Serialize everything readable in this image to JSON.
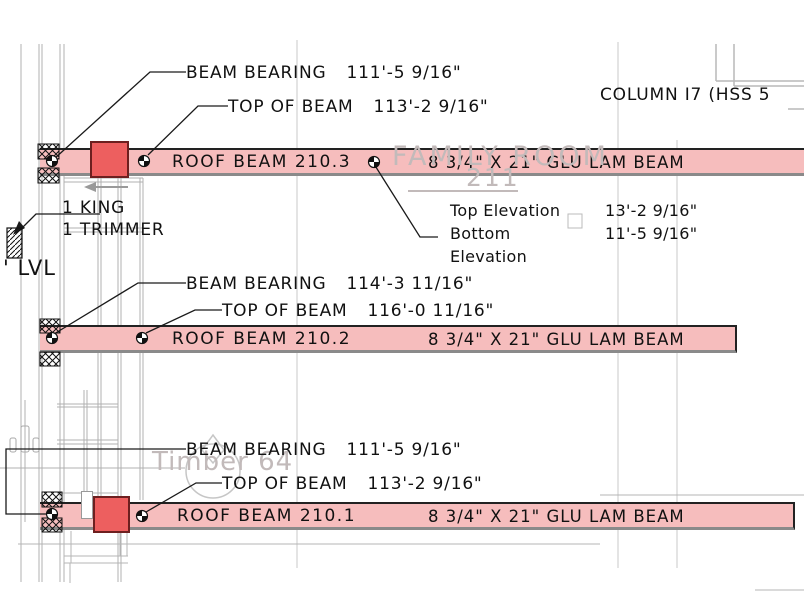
{
  "annotations": {
    "beam_bearing_1": {
      "label": "BEAM BEARING",
      "value": "111'-5 9/16\""
    },
    "top_of_beam_1": {
      "label": "TOP OF BEAM",
      "value": "113'-2 9/16\""
    },
    "beam_bearing_2": {
      "label": "BEAM BEARING",
      "value": "114'-3 11/16\""
    },
    "top_of_beam_2": {
      "label": "TOP OF BEAM",
      "value": "116'-0 11/16\""
    },
    "beam_bearing_3": {
      "label": "BEAM BEARING",
      "value": "111'-5 9/16\""
    },
    "top_of_beam_3": {
      "label": "TOP OF BEAM",
      "value": "113'-2 9/16\""
    },
    "column_label": "COLUMN I7 (HSS 5",
    "king": "1 KING",
    "trimmer": "1 TRIMMER",
    "lvl": "' LVL",
    "top_elev_label": "Top Elevation",
    "top_elev_value": "13'-2 9/16\"",
    "bottom_elev_label_1": "Bottom",
    "bottom_elev_label_2": "Elevation",
    "bottom_elev_value": "11'-5 9/16\""
  },
  "beams": [
    {
      "name": "ROOF BEAM 210.3",
      "size": "8 3/4\" X 21\" GLU LAM BEAM"
    },
    {
      "name": "ROOF BEAM 210.2",
      "size": "8 3/4\" X 21\" GLU LAM BEAM"
    },
    {
      "name": "ROOF BEAM 210.1",
      "size": "8 3/4\" X 21\" GLU LAM BEAM"
    }
  ],
  "watermarks": {
    "room_name": "FAMILY ROOM",
    "room_number": "211",
    "detail_tag": "Timber 64"
  },
  "colors": {
    "beam_fill": "#f6bdbd",
    "beam_block": "#ed5f5f",
    "beam_border_top": "#222222",
    "beam_border_bottom": "#8a8a8a",
    "watermark_gray": "#c2baba",
    "grid_gray": "#c2c2c2",
    "stud_gray": "#b0b0b0",
    "annotation_black": "#1a1a1a"
  }
}
